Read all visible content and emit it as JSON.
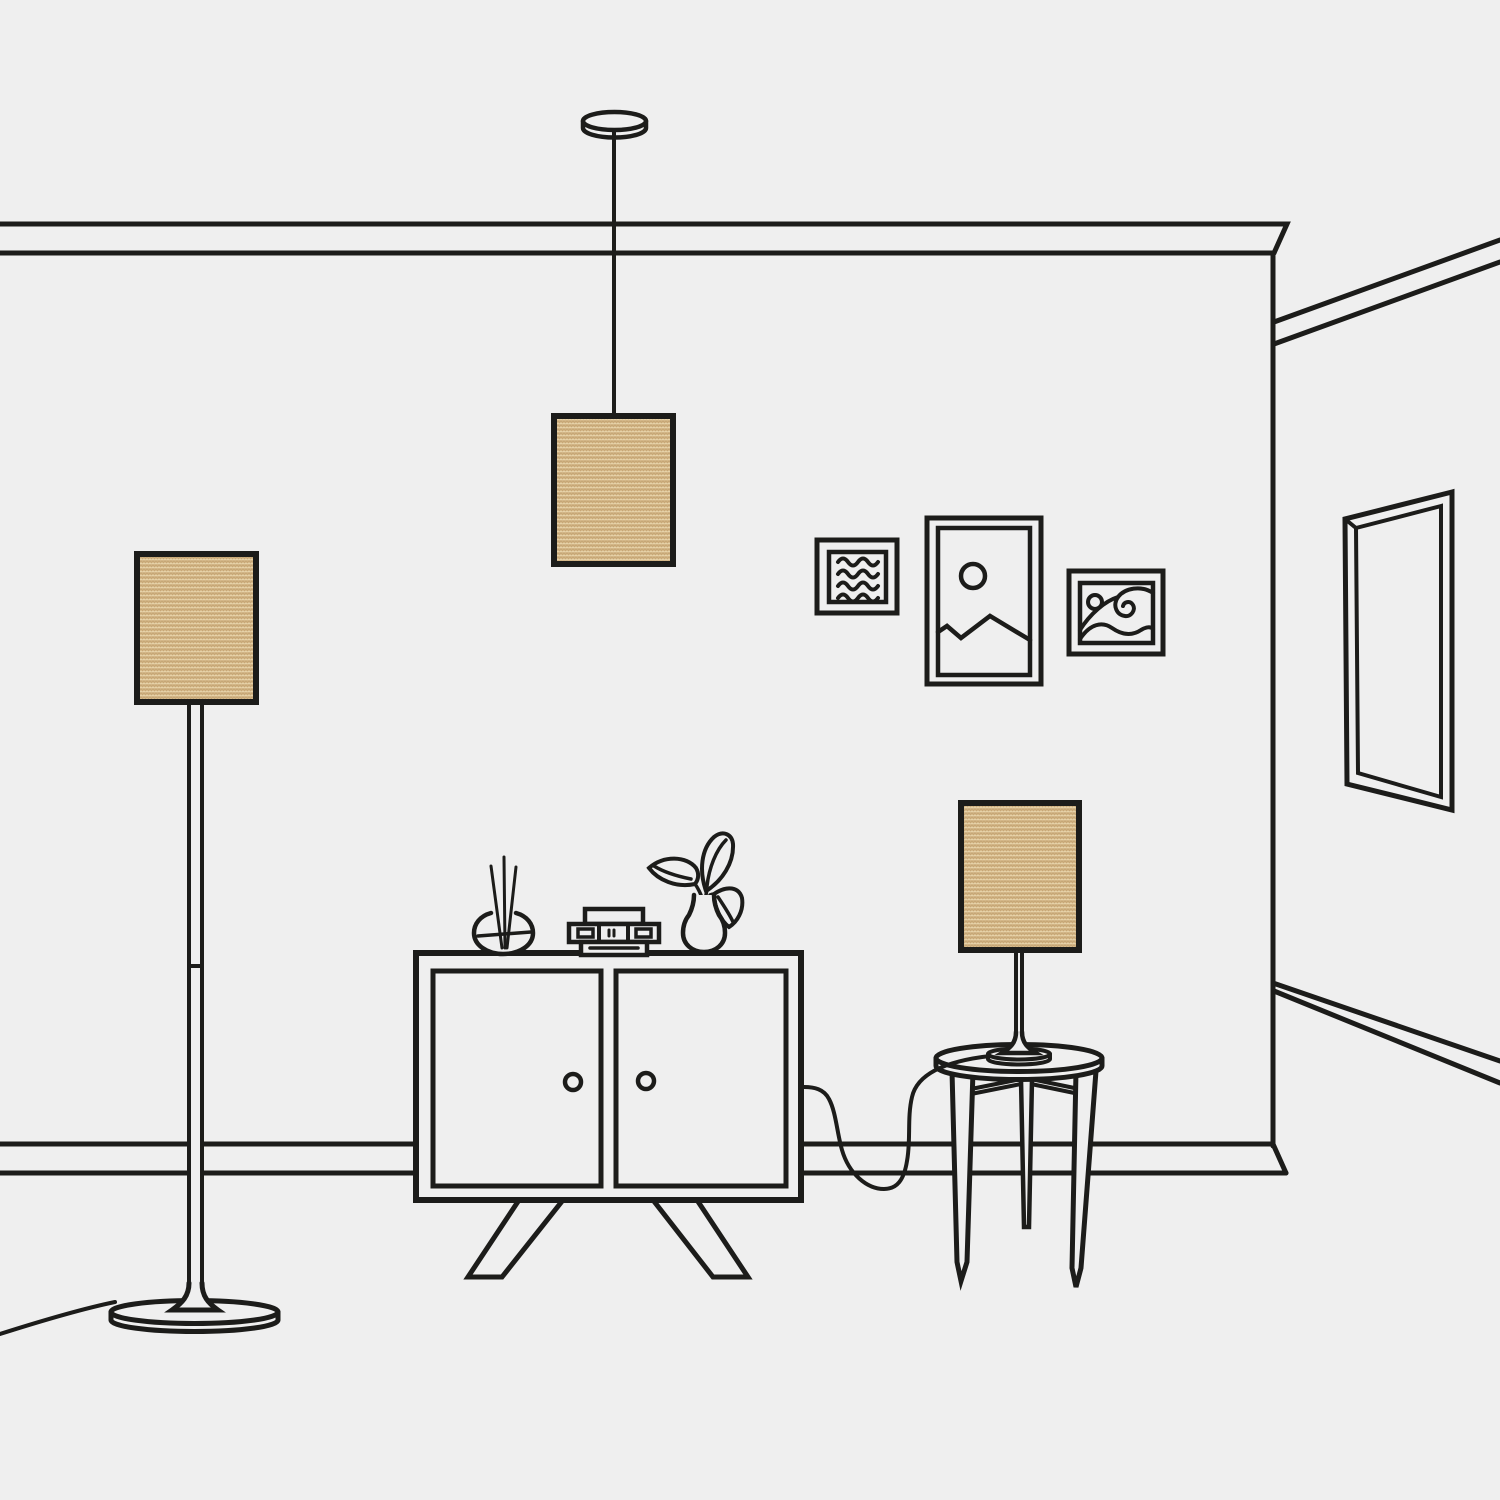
{
  "scene": {
    "description": "Line-art illustration of a living room interior showcasing three matching woven lampshades: a ceiling pendant, a floor lamp and a table lamp",
    "background_color": "#efefef",
    "outline_color": "#1c1c1a",
    "lampshade_color": "#d5b88a",
    "lampshade_texture_dark": "#c1a06e",
    "lampshade_texture_light": "#ead9b0",
    "objects": [
      "pendant-lamp-with-woven-shade",
      "floor-lamp-with-woven-shade",
      "table-lamp-with-woven-shade",
      "two-door-cabinet-with-splayed-legs",
      "reed-diffuser",
      "stacked-books",
      "bud-vase-with-plant",
      "round-three-leg-side-table",
      "framed-art-wavy-lines",
      "framed-art-mountains-and-sun",
      "framed-art-ocean-wave",
      "tall-wall-mirror",
      "crown-molding",
      "baseboard",
      "power-cords"
    ],
    "lampshade_count": "3"
  }
}
